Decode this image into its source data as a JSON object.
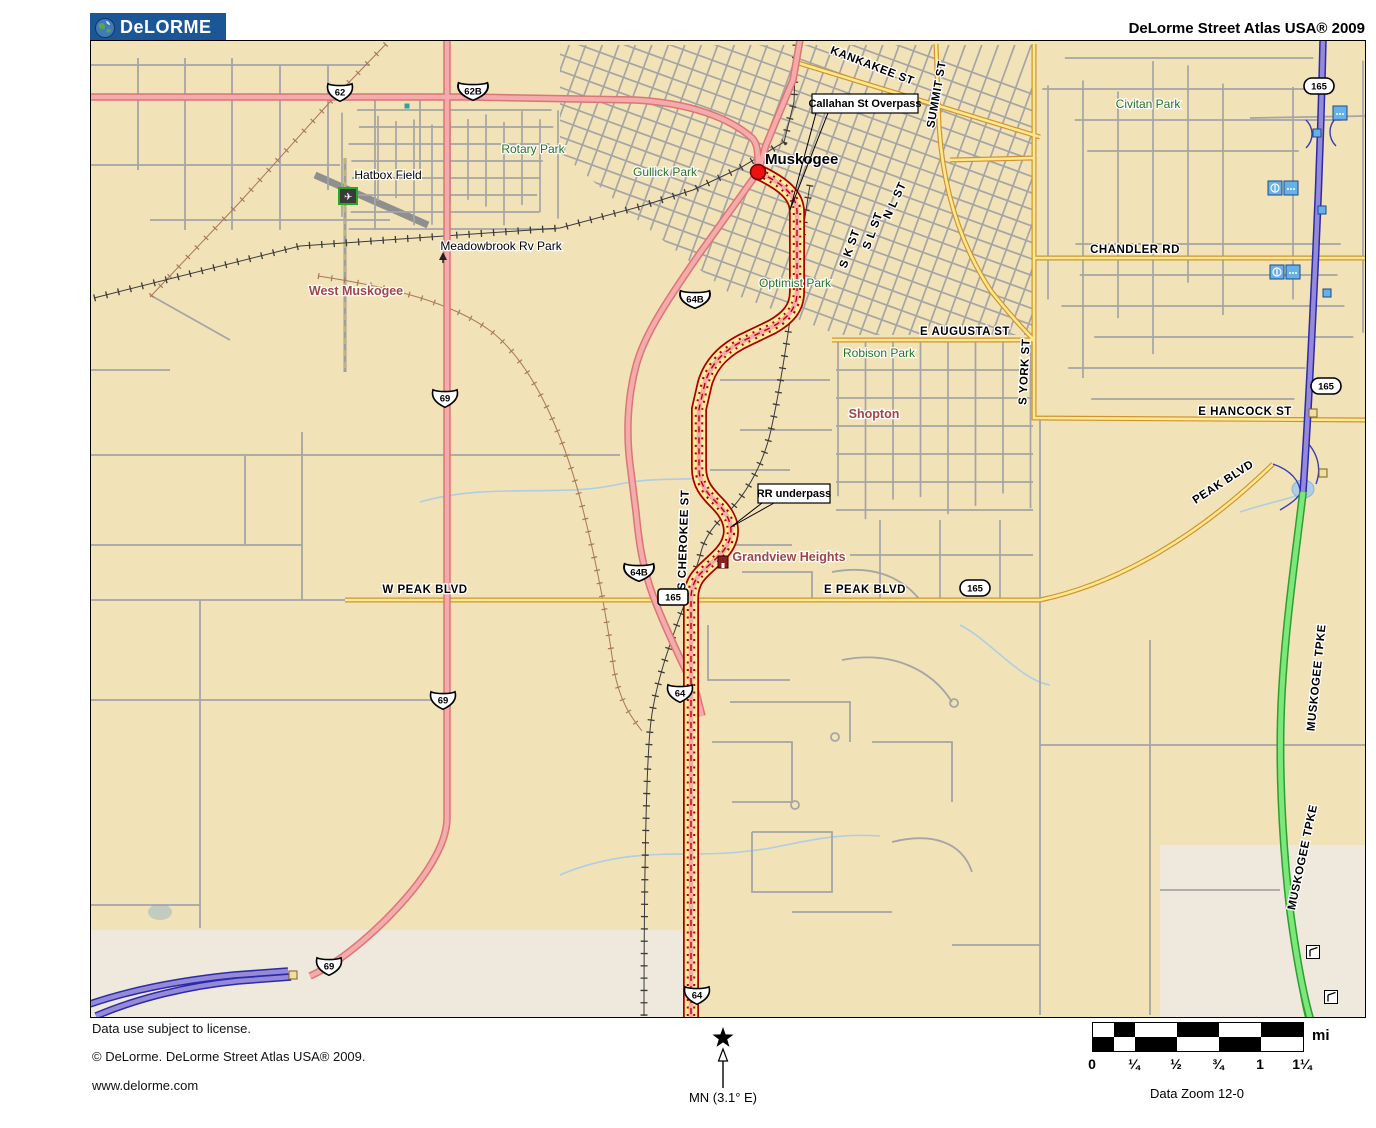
{
  "header": {
    "logo_text": "DeLORME",
    "title": "DeLorme Street Atlas USA® 2009"
  },
  "map": {
    "colors": {
      "tan": "#F2E2B8",
      "light": "#EEE9DC",
      "water": "#AFCDE4",
      "pink": "#F4ABAB",
      "pinkEdge": "#DC7575",
      "yellow": "#FFE98E",
      "yellowEdge": "#CE9434",
      "purple": "#9589D9",
      "purpleEdge": "#2B2BA8",
      "green": "#7CE87C",
      "greenEdge": "#2E9E2E",
      "routeYellow": "#FFEC9A",
      "routeEdge": "#A80000",
      "gray": "#A5A5A5",
      "park": "#267326",
      "place": "#A04545"
    },
    "labels": {
      "city": [
        {
          "t": "Muskogee",
          "x": 675,
          "y": 124
        }
      ],
      "parks": [
        {
          "t": "Rotary Park",
          "x": 443,
          "y": 113
        },
        {
          "t": "Gullick Park",
          "x": 575,
          "y": 136
        },
        {
          "t": "Civitan Park",
          "x": 1058,
          "y": 68
        },
        {
          "t": "Optimist Park",
          "x": 705,
          "y": 247
        },
        {
          "t": "Robison Park",
          "x": 789,
          "y": 317
        }
      ],
      "places": [
        {
          "t": "West Muskogee",
          "x": 266,
          "y": 255
        },
        {
          "t": "Shopton",
          "x": 784,
          "y": 378
        },
        {
          "t": "Grandview Heights",
          "x": 699,
          "y": 521
        }
      ],
      "poi": [
        {
          "t": "Hatbox Field",
          "x": 298,
          "y": 139
        },
        {
          "t": "Meadowbrook Rv Park",
          "x": 411,
          "y": 210
        }
      ],
      "streets": [
        {
          "t": "KANKAKEE ST",
          "x": 781,
          "y": 29,
          "r": 21
        },
        {
          "t": "SUMMIT ST",
          "x": 850,
          "y": 55,
          "r": -80
        },
        {
          "t": "N L ST",
          "x": 808,
          "y": 162,
          "r": -65
        },
        {
          "t": "S L ST",
          "x": 786,
          "y": 192,
          "r": -70
        },
        {
          "t": "S K ST",
          "x": 763,
          "y": 210,
          "r": -70
        },
        {
          "t": "E AUGUSTA ST",
          "x": 875,
          "y": 295,
          "r": 0
        },
        {
          "t": "S YORK ST",
          "x": 938,
          "y": 332,
          "r": -87
        },
        {
          "t": "CHANDLER RD",
          "x": 1045,
          "y": 213,
          "r": 0
        },
        {
          "t": "E HANCOCK ST",
          "x": 1155,
          "y": 375,
          "r": 0
        },
        {
          "t": "PEAK BLVD",
          "x": 1135,
          "y": 445,
          "r": -33
        },
        {
          "t": "W PEAK BLVD",
          "x": 335,
          "y": 553,
          "r": 0
        },
        {
          "t": "E PEAK BLVD",
          "x": 775,
          "y": 553,
          "r": 0
        },
        {
          "t": "S CHEROKEE ST",
          "x": 597,
          "y": 500,
          "r": -88
        },
        {
          "t": "MUSKOGEE TPKE",
          "x": 1230,
          "y": 638,
          "r": -84
        },
        {
          "t": "MUSKOGEE TPKE",
          "x": 1216,
          "y": 818,
          "r": -78
        }
      ]
    },
    "callouts": [
      {
        "t": "Callahan St Overpass",
        "bx": 722,
        "by": 54,
        "bw": 106,
        "bh": 19,
        "tx": 700,
        "ty": 170
      },
      {
        "t": "RR underpass",
        "bx": 668,
        "by": 444,
        "bw": 72,
        "bh": 19,
        "tx": 641,
        "ty": 487
      }
    ],
    "shields": [
      {
        "k": "us",
        "t": "62",
        "x": 250,
        "y": 52
      },
      {
        "k": "us",
        "t": "62B",
        "x": 383,
        "y": 51
      },
      {
        "k": "us",
        "t": "69",
        "x": 355,
        "y": 358
      },
      {
        "k": "us",
        "t": "69",
        "x": 353,
        "y": 660
      },
      {
        "k": "us",
        "t": "69",
        "x": 239,
        "y": 926
      },
      {
        "k": "us",
        "t": "64B",
        "x": 605,
        "y": 259
      },
      {
        "k": "us",
        "t": "64B",
        "x": 549,
        "y": 532
      },
      {
        "k": "us",
        "t": "64",
        "x": 590,
        "y": 653
      },
      {
        "k": "us",
        "t": "64",
        "x": 607,
        "y": 955
      },
      {
        "k": "rect",
        "t": "165",
        "x": 583,
        "y": 557
      },
      {
        "k": "oval",
        "t": "165",
        "x": 885,
        "y": 548
      },
      {
        "k": "oval",
        "t": "165",
        "x": 1229,
        "y": 46
      },
      {
        "k": "oval",
        "t": "165",
        "x": 1236,
        "y": 346
      }
    ],
    "icons": [
      {
        "k": "city-dot",
        "x": 668,
        "y": 132
      },
      {
        "k": "airport",
        "x": 258,
        "y": 156
      },
      {
        "k": "camp",
        "x": 353,
        "y": 217
      },
      {
        "k": "building",
        "x": 633,
        "y": 522
      },
      {
        "k": "teal",
        "x": 317,
        "y": 66
      },
      {
        "k": "rest-pair",
        "x": 1193,
        "y": 148
      },
      {
        "k": "rest-pair",
        "x": 1195,
        "y": 232
      },
      {
        "k": "dots",
        "x": 1250,
        "y": 73
      },
      {
        "k": "exit",
        "x": 1227,
        "y": 93
      },
      {
        "k": "exit",
        "x": 1232,
        "y": 170
      },
      {
        "k": "exit",
        "x": 1237,
        "y": 253
      },
      {
        "k": "yexit",
        "x": 1223,
        "y": 373
      },
      {
        "k": "yexit",
        "x": 1233,
        "y": 433
      },
      {
        "k": "yexit",
        "x": 203,
        "y": 935
      },
      {
        "k": "toll",
        "x": 1223,
        "y": 912
      },
      {
        "k": "toll",
        "x": 1241,
        "y": 957
      }
    ]
  },
  "footer": {
    "license": "Data use subject to license.",
    "copyright": "© DeLorme. DeLorme Street Atlas USA® 2009.",
    "website": "www.delorme.com",
    "north_label": "MN (3.1° E)",
    "scale_unit": "mi",
    "scale_ticks": [
      "0",
      "¼",
      "½",
      "¾",
      "1",
      "1¼"
    ],
    "data_zoom": "Data Zoom 12-0"
  }
}
